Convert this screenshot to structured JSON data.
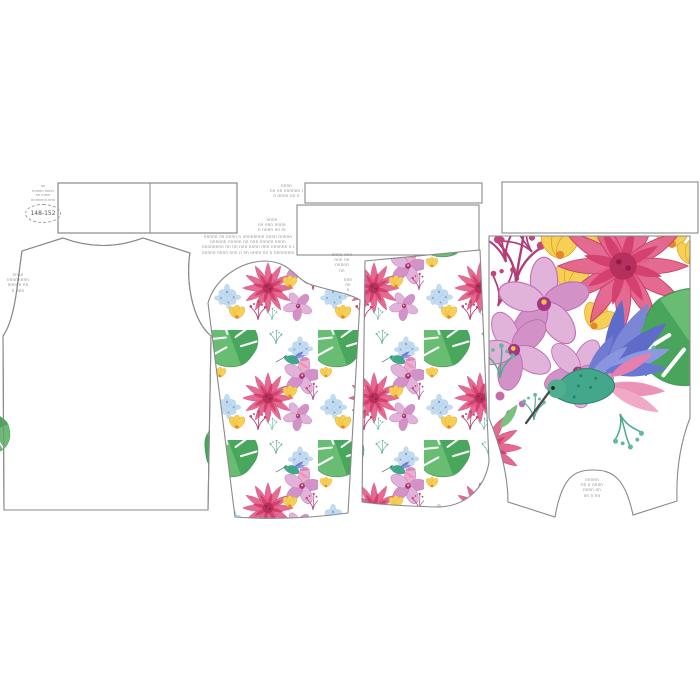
{
  "product": {
    "size_label": "148-152"
  },
  "colors": {
    "outline": "#8a8a8a",
    "dahlia_pink": "#e4628c",
    "orchid_pink": "#d99ed0",
    "hydrangea_blue": "#c3dcf2",
    "leaf_green": "#58b368",
    "flower_yellow": "#f6d054",
    "bird_teal": "#43a78c",
    "wing_violet": "#6f7cd2",
    "feather_pink": "#ec93ba",
    "sprig_magenta": "#c2457f",
    "sprig_teal": "#4fa98e"
  },
  "microtext": {
    "stamp": [
      "nn",
      "nnnnn nnnn",
      "nn nnnn",
      "nnnnnnn nnn"
    ],
    "armhole_note": [
      "nnnn",
      "nnnnnnnn",
      "nnnnn nn",
      "n nnn"
    ],
    "disclaimer": [
      "nnnnn nn nnnn n nnnnnnnn nnnn nnnnn",
      "nnnnnn nnnnn nn nnn nnnnn nnnn",
      "nnnnnnnn nn nn nnn nnnn nnn nnnnnn n nnnn",
      "nnnnn nnnn nnn n nn nnnn nn n nnnnnnnn"
    ],
    "cutting_note": [
      "nnnn",
      "nn nnn nnnnn n",
      "n nnnn nn nn"
    ],
    "strip_note": [
      "nnnn",
      "nn nn nnnnnn n",
      "n nnnn nn n"
    ],
    "sleeve_note": [
      "nnnn nnn",
      "nnn nn",
      "nnnnn",
      "nn"
    ],
    "sleeve_mark": [
      "nnn",
      "nn",
      "n",
      "nn"
    ],
    "panel_note": [
      "nnnnn",
      "nn n nnnn",
      "nnnn nn",
      "nn n nn"
    ]
  }
}
